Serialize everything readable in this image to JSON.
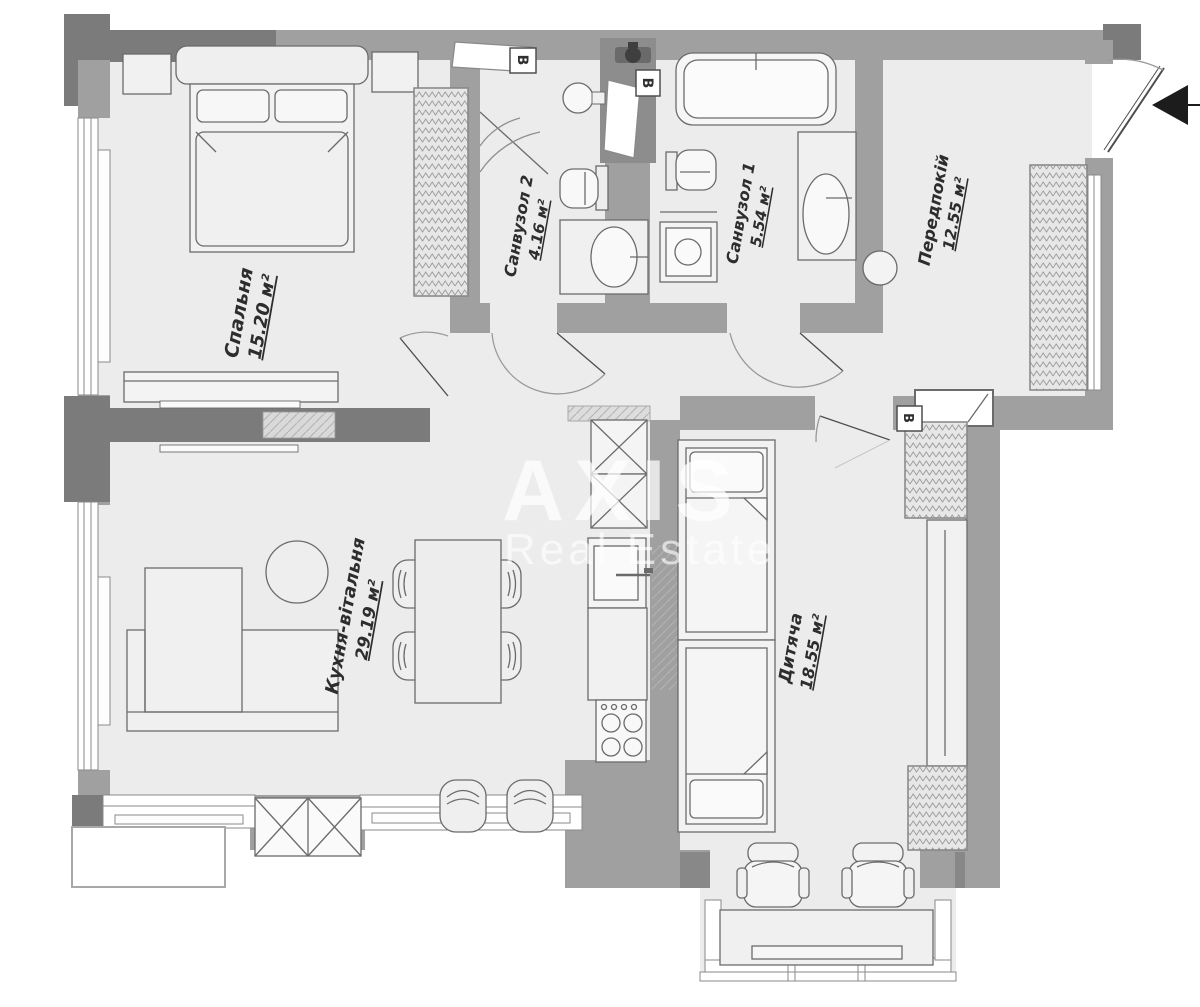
{
  "plan": {
    "type": "apartment-floor-plan",
    "language": "uk",
    "watermark": {
      "brand": "AXIS",
      "subtitle": "Real Estate"
    },
    "markers": {
      "vent": "В"
    },
    "rooms": [
      {
        "id": "bedroom",
        "name": "Спальня",
        "area": "15.20 м²"
      },
      {
        "id": "bathroom2",
        "name": "Санвузол 2",
        "area": "4.16 м²"
      },
      {
        "id": "bathroom1",
        "name": "Санвузол 1",
        "area": "5.54 м²"
      },
      {
        "id": "hallway",
        "name": "Передпокій",
        "area": "12.55 м²"
      },
      {
        "id": "kitchen-living",
        "name": "Кухня-вітальня",
        "area": "29.19 м²"
      },
      {
        "id": "kids-room",
        "name": "Дитяча",
        "area": "18.55 м²"
      }
    ],
    "colors": {
      "wall": "#a0a0a0",
      "wall_dark": "#7b7b7b",
      "floor": "#ececec",
      "line": "#6b6b6b"
    }
  }
}
